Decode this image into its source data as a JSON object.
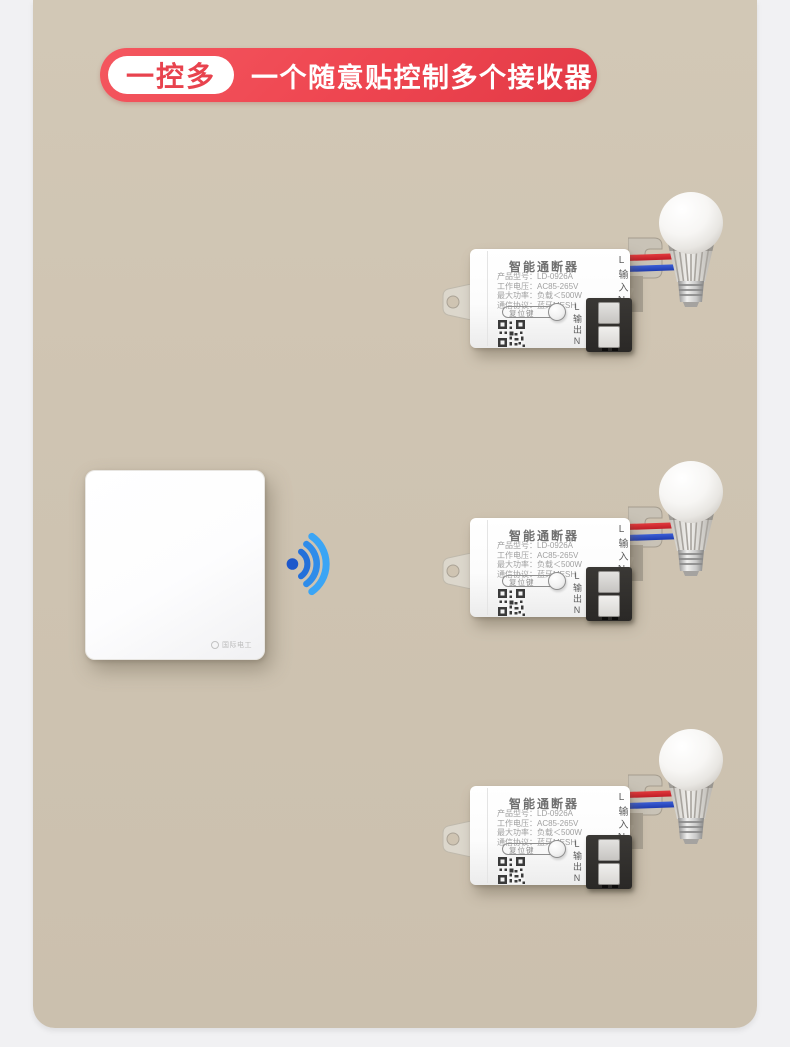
{
  "page": {
    "background_color": "#f1f1f3",
    "card_color": "#cfc4b2"
  },
  "header": {
    "badge_label": "一控多",
    "headline": "一个随意贴控制多个接收器",
    "accent_color": "#ee4550"
  },
  "remote_switch": {
    "brand": "国际电工"
  },
  "wifi_icon": {
    "color": "#2f8ce9"
  },
  "receiver_count": 3,
  "receiver": {
    "title": "智能通断器",
    "spec_lines": [
      "产品型号：LD-0926A",
      "工作电压：AC85-265V",
      "最大功率：负载＜500W",
      "通信协议：蓝牙MESH"
    ],
    "reset_label": "复位键",
    "input_label": "L输入N",
    "output_label": "L输出N"
  }
}
